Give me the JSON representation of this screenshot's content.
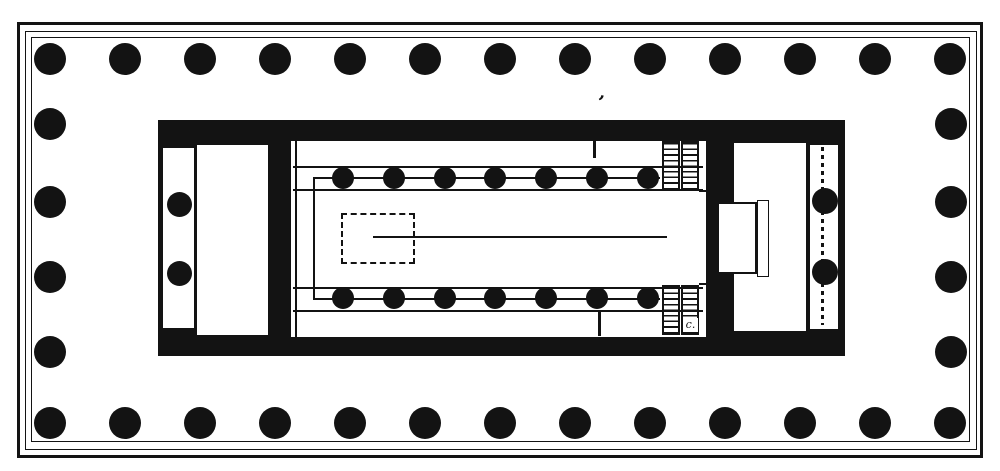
{
  "figure": {
    "kind": "engraved architectural plan",
    "subject": "Ground plan of a Greek peripteral temple: 6 x 13 column peristyle, cella with double interior colonnade, porches in antis, twin staircases and dashed statue-base",
    "ink": "#131313",
    "paper": "#ffffff"
  },
  "labels": {
    "corner_mark": "’",
    "stair_letter": "c."
  },
  "columns": {
    "outer": {
      "radius": 16,
      "top_row": {
        "y": 59,
        "xs": [
          50,
          125,
          200,
          275,
          350,
          425,
          500,
          575,
          650,
          725,
          800,
          875,
          950
        ]
      },
      "bottom_row": {
        "y": 423,
        "xs": [
          50,
          125,
          200,
          275,
          350,
          425,
          500,
          575,
          650,
          725,
          800,
          875,
          950
        ]
      },
      "left_col": {
        "x": 50,
        "ys": [
          124,
          202,
          277,
          352
        ]
      },
      "right_col": {
        "x": 951,
        "ys": [
          124,
          202,
          277,
          352
        ]
      }
    },
    "cella_inner": {
      "radius": 11,
      "top_row": {
        "y": 178,
        "xs": [
          343,
          394,
          445,
          495,
          546,
          597,
          648
        ]
      },
      "bottom_row": {
        "y": 298,
        "xs": [
          343,
          394,
          445,
          495,
          546,
          597,
          648
        ]
      }
    },
    "west_porch": {
      "radius": 12.5,
      "x": 179,
      "ys": [
        204,
        273
      ]
    },
    "east_porch": {
      "radius": 13,
      "x": 825,
      "ys": [
        201,
        272
      ]
    }
  },
  "statue_base": {
    "x": 341,
    "y": 213,
    "w": 74,
    "h": 51
  },
  "axis_line": {
    "y": 237,
    "x1": 373,
    "x2": 667
  }
}
